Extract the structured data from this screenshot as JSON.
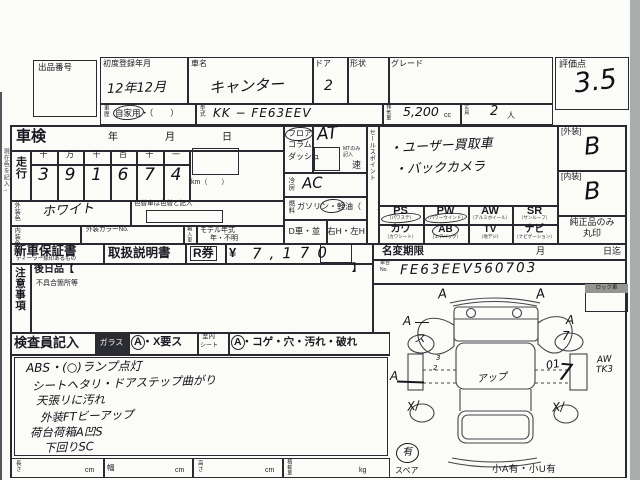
{
  "header": {
    "lot_label": "出品番号",
    "first_reg_label": "初度登録年月",
    "first_reg_value": "12年12月",
    "name_label": "車名",
    "name_value": "キャンター",
    "door_label": "ドア",
    "door_value": "2",
    "body_label": "形状",
    "grade_label": "グレード",
    "score_label": "評価点",
    "score_value": "3.5",
    "history_label": "車歴",
    "history_value": "自家用・（　　）",
    "model_label": "型式",
    "model_value": "KK − FE63EEV",
    "disp_label": "排気量",
    "disp_value": "5,200",
    "disp_unit": "cc",
    "cap_label": "定員",
    "cap_value": "2",
    "cap_unit": "人"
  },
  "margin_note": "現在色を記入→",
  "shaken": {
    "label": "車検",
    "year": "年",
    "month": "月",
    "day": "日"
  },
  "mileage": {
    "label": "走行",
    "cols": [
      "十",
      "万",
      "千",
      "百",
      "十",
      "一"
    ],
    "digits": [
      "3",
      "9",
      "1",
      "6",
      "7",
      "4"
    ],
    "unit": "km（　　）"
  },
  "paint": {
    "ext_label": "外装色",
    "ext_value": "ホワイト",
    "repaint_note": "色替車は色替と記入",
    "int_label": "内装色",
    "color_no_label": "外装カラーNo.",
    "import_label": "輸入車",
    "my_label": "モデル年式",
    "my_value": "年・不明"
  },
  "shift": {
    "opt1": "フロア",
    "opt2": "コラム",
    "opt3": "ダッシュ",
    "value": "AT",
    "mt_note_1": "MTのみ",
    "mt_note_2": "記入",
    "speed": "速"
  },
  "ac": {
    "label": "冷房",
    "value": "AC"
  },
  "fuel": {
    "label": "燃料",
    "value": "ガソリン・軽油（　　）"
  },
  "drive": {
    "left": "D車・並",
    "right": "右H・左H"
  },
  "sales": {
    "label": "セールスポイント",
    "item1": "・ユーザー買取車",
    "item2": "・バックカメラ"
  },
  "equip": {
    "r1c1": "PS",
    "r1c1k": "（パワステ）",
    "r1c2": "PW",
    "r1c2k": "（パワーウインド）",
    "r1c3": "AW",
    "r1c3k": "（アルミホイール）",
    "r1c4": "SR",
    "r1c4k": "（サンルーフ）",
    "r2c1": "カワ",
    "r2c1k": "（カワシート）",
    "r2c2": "AB",
    "r2c2k": "（エアバッグ）",
    "r2c3": "TV",
    "r2c3k": "（地デジ）",
    "r2c4": "ナビ",
    "r2c4k": "（ナビゲーション）"
  },
  "docs": {
    "warranty": "新車保証書",
    "warranty_note": "ディーラー捺印あるもの",
    "manual": "取扱説明書",
    "rticket": "R券",
    "yen": "¥",
    "amount": "7,170"
  },
  "rename": {
    "label": "名変期限",
    "month": "月",
    "until": "日迄"
  },
  "chassis": {
    "label_1": "車台",
    "label_2": "No.",
    "value": "FE63EEV560703"
  },
  "grades": {
    "ext_label": "[外装]",
    "ext_value": "B",
    "int_label": "[内装]",
    "int_value": "B",
    "genuine_1": "純正品のみ",
    "genuine_2": "丸印"
  },
  "caution": {
    "label": "注意事項",
    "later": "後日品【",
    "later_close": "】",
    "defect": "不具合箇所等"
  },
  "inspector": {
    "label": "検査員記入",
    "glass": "ガラス",
    "glass_note": "A・X要ス",
    "seat_1": "室内",
    "seat_2": "シート",
    "seat_note": "A・コゲ・穴・汚れ・破れ",
    "lines": [
      "ABS・(○)ランプ点灯",
      "シートヘタリ・ドアステップ曲がり",
      "天張リに汚れ",
      "外装FTビーアップ",
      "荷台荷箱A凹S",
      "下回りSC"
    ]
  },
  "dims": {
    "length": "長さ",
    "width": "幅",
    "height": "高さ",
    "load": "積載量",
    "cm": "cm",
    "kg": "kg"
  },
  "diagram": {
    "lock": "ロック車",
    "spare_label": "スペア",
    "spare_value": "有",
    "footer": "小A有・小U有",
    "marks": {
      "a_tl": "A",
      "a_tr": "A",
      "a_ml": "A",
      "a_mr": "A",
      "wheel_fl": "ス",
      "wheel_fr": "7",
      "a_side": "A",
      "n3": "3",
      "n2": "2",
      "up": "アップ",
      "n01": "01",
      "big7": "7",
      "aw": "AW",
      "tk3": "TK3",
      "x_rl": "X/",
      "x_rr": "X/"
    }
  }
}
